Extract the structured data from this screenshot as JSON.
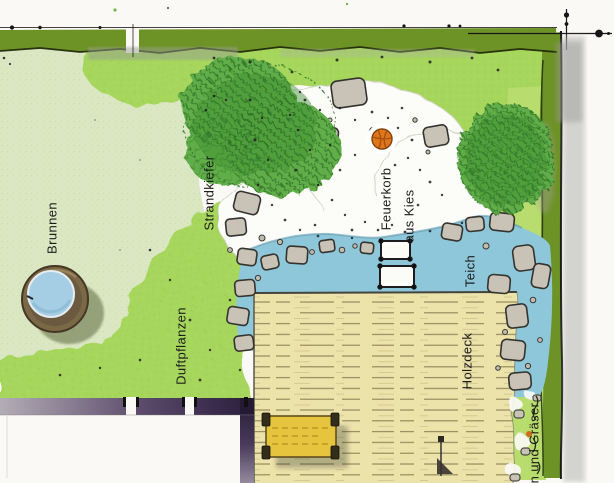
{
  "plan": {
    "labels": {
      "brunnen": "Brunnen",
      "strandkiefer": "Strandkiefer",
      "feuerkorb_line1": "Feuerkorb",
      "feuerkorb_line2": "aus Kies",
      "teich": "Teich",
      "duftpflanzen": "Duftpflanzen",
      "holzdeck": "Holzdeck",
      "graeser": "n und Gräser"
    }
  },
  "colors": {
    "page_bg": "#faf9f5",
    "lawn_pale": "#dbe7c3",
    "lawn_bright": "#a6d65c",
    "hedge_olive": "#6d9226",
    "strip_light": "#b9dc6e",
    "tree_green": "#61ad48",
    "tree_dark": "#2b6e23",
    "gravel_white": "#fcfcf9",
    "stone_gray": "#c9c3b7",
    "pond_blue": "#8ec7d9",
    "deck_tan": "#ece3ab",
    "deck_line": "#7d7345",
    "bench_yellow": "#e7c43e",
    "fire_orange": "#e0751c",
    "well_rim": "#7b6847",
    "well_water": "#a5cde4",
    "wall_dark": "#3a2c4a",
    "ink": "#1b1b1b"
  }
}
